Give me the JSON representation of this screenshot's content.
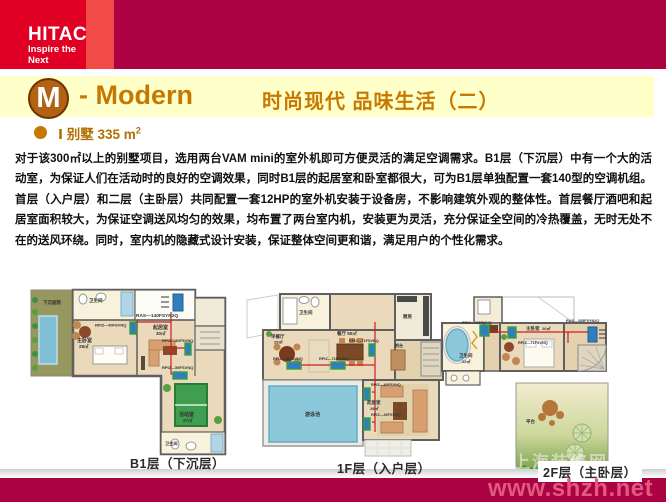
{
  "header": {
    "brand": "HITACHI",
    "tagline": "Inspire the Next"
  },
  "title": {
    "badge": "M",
    "en": "- Modern",
    "cn": "时尚现代 品味生活（二）"
  },
  "intro": {
    "bullet": "Ⅰ 别墅  335 m",
    "bullet_sup": "2"
  },
  "body": {
    "paragraph": "对于该300㎡以上的别墅项目，选用两台VAM mini的室外机即可方便灵活的满足空调需求。B1层（下沉层）中有一个大的活动室，为保证人们在活动时的良好的空调效果，同时B1层的起居室和卧室都很大，可为B1层单独配置一套140型的空调机组。首层（入户层）和二层（主卧层）共同配置一套12HP的室外机安装于设备房，不影响建筑外观的整体性。首层餐厅酒吧和起居室面积较大，为保证空调送风均匀的效果，均布置了两台室内机，安装更为灵活，充分保证全空间的冷热覆盖，无时无处不在的送风环绕。同时，室内机的隐藏式设计安装，保证整体空间更和谐，满足用户的个性化需求。"
  },
  "floorplans": [
    {
      "caption": "B1层（下沉层）",
      "outdoor_unit": "RAS—140FSYN2Q",
      "indoor_units": {
        "u1": "RPIZ—40FSVNQ",
        "u2": "RPIZ—40FSVNQ",
        "u3": "RPIZ—56FSVNQ"
      },
      "rooms": {
        "courtyard": "下沉庭院",
        "bath_top": "卫生间",
        "bedroom": "主卧室",
        "bedroom_area": "28㎡",
        "living": "起居室",
        "living_area": "30㎡",
        "activity": "活动室",
        "activity_area": "27㎡",
        "bath_bottom": "卫生间"
      }
    },
    {
      "caption": "1F层（入户层）",
      "indoor_units": {
        "u1": "RPIZ—56FSVNQ",
        "u2": "RPIZ—71FSVNQ",
        "u3": "RPIZ—71FSVNQ",
        "u4": "RPIZ—40FSVNQ",
        "u5": "RPIZ—40FSVNQ"
      },
      "rooms": {
        "bath": "卫生间",
        "breakfast": "早餐厅",
        "breakfast_area": "25㎡",
        "dining": "餐厅 50㎡",
        "kitchen": "厨房",
        "bar": "吧台",
        "pool": "游泳池",
        "living": "起居室",
        "living_area": "28㎡"
      }
    },
    {
      "caption": "2F层（主卧层）",
      "outdoor_unit": "RAS—335FSYN2Q",
      "indoor_units": {
        "u1": "RPIZ—40FSVNQ",
        "u2": "RPIZ—71FSVNQ"
      },
      "rooms": {
        "bath": "卫生间",
        "bath_area": "22㎡",
        "bedroom": "主卧室",
        "bedroom_area": "26㎡",
        "terrace": "平台"
      }
    }
  ],
  "footer": {
    "watermark": "www.shzh.net",
    "ghost": "上海装修网"
  },
  "colors": {
    "brand_red": "#DF0024",
    "accent_strip": "#F24B47",
    "crimson": "#AB0243",
    "band_yellow": "#FFFFC9",
    "title_orange": "#C87800",
    "watermark_pink": "#E25A80",
    "indoor_unit_blue": "#2f7fc0",
    "piping_red": "#cc2020"
  }
}
